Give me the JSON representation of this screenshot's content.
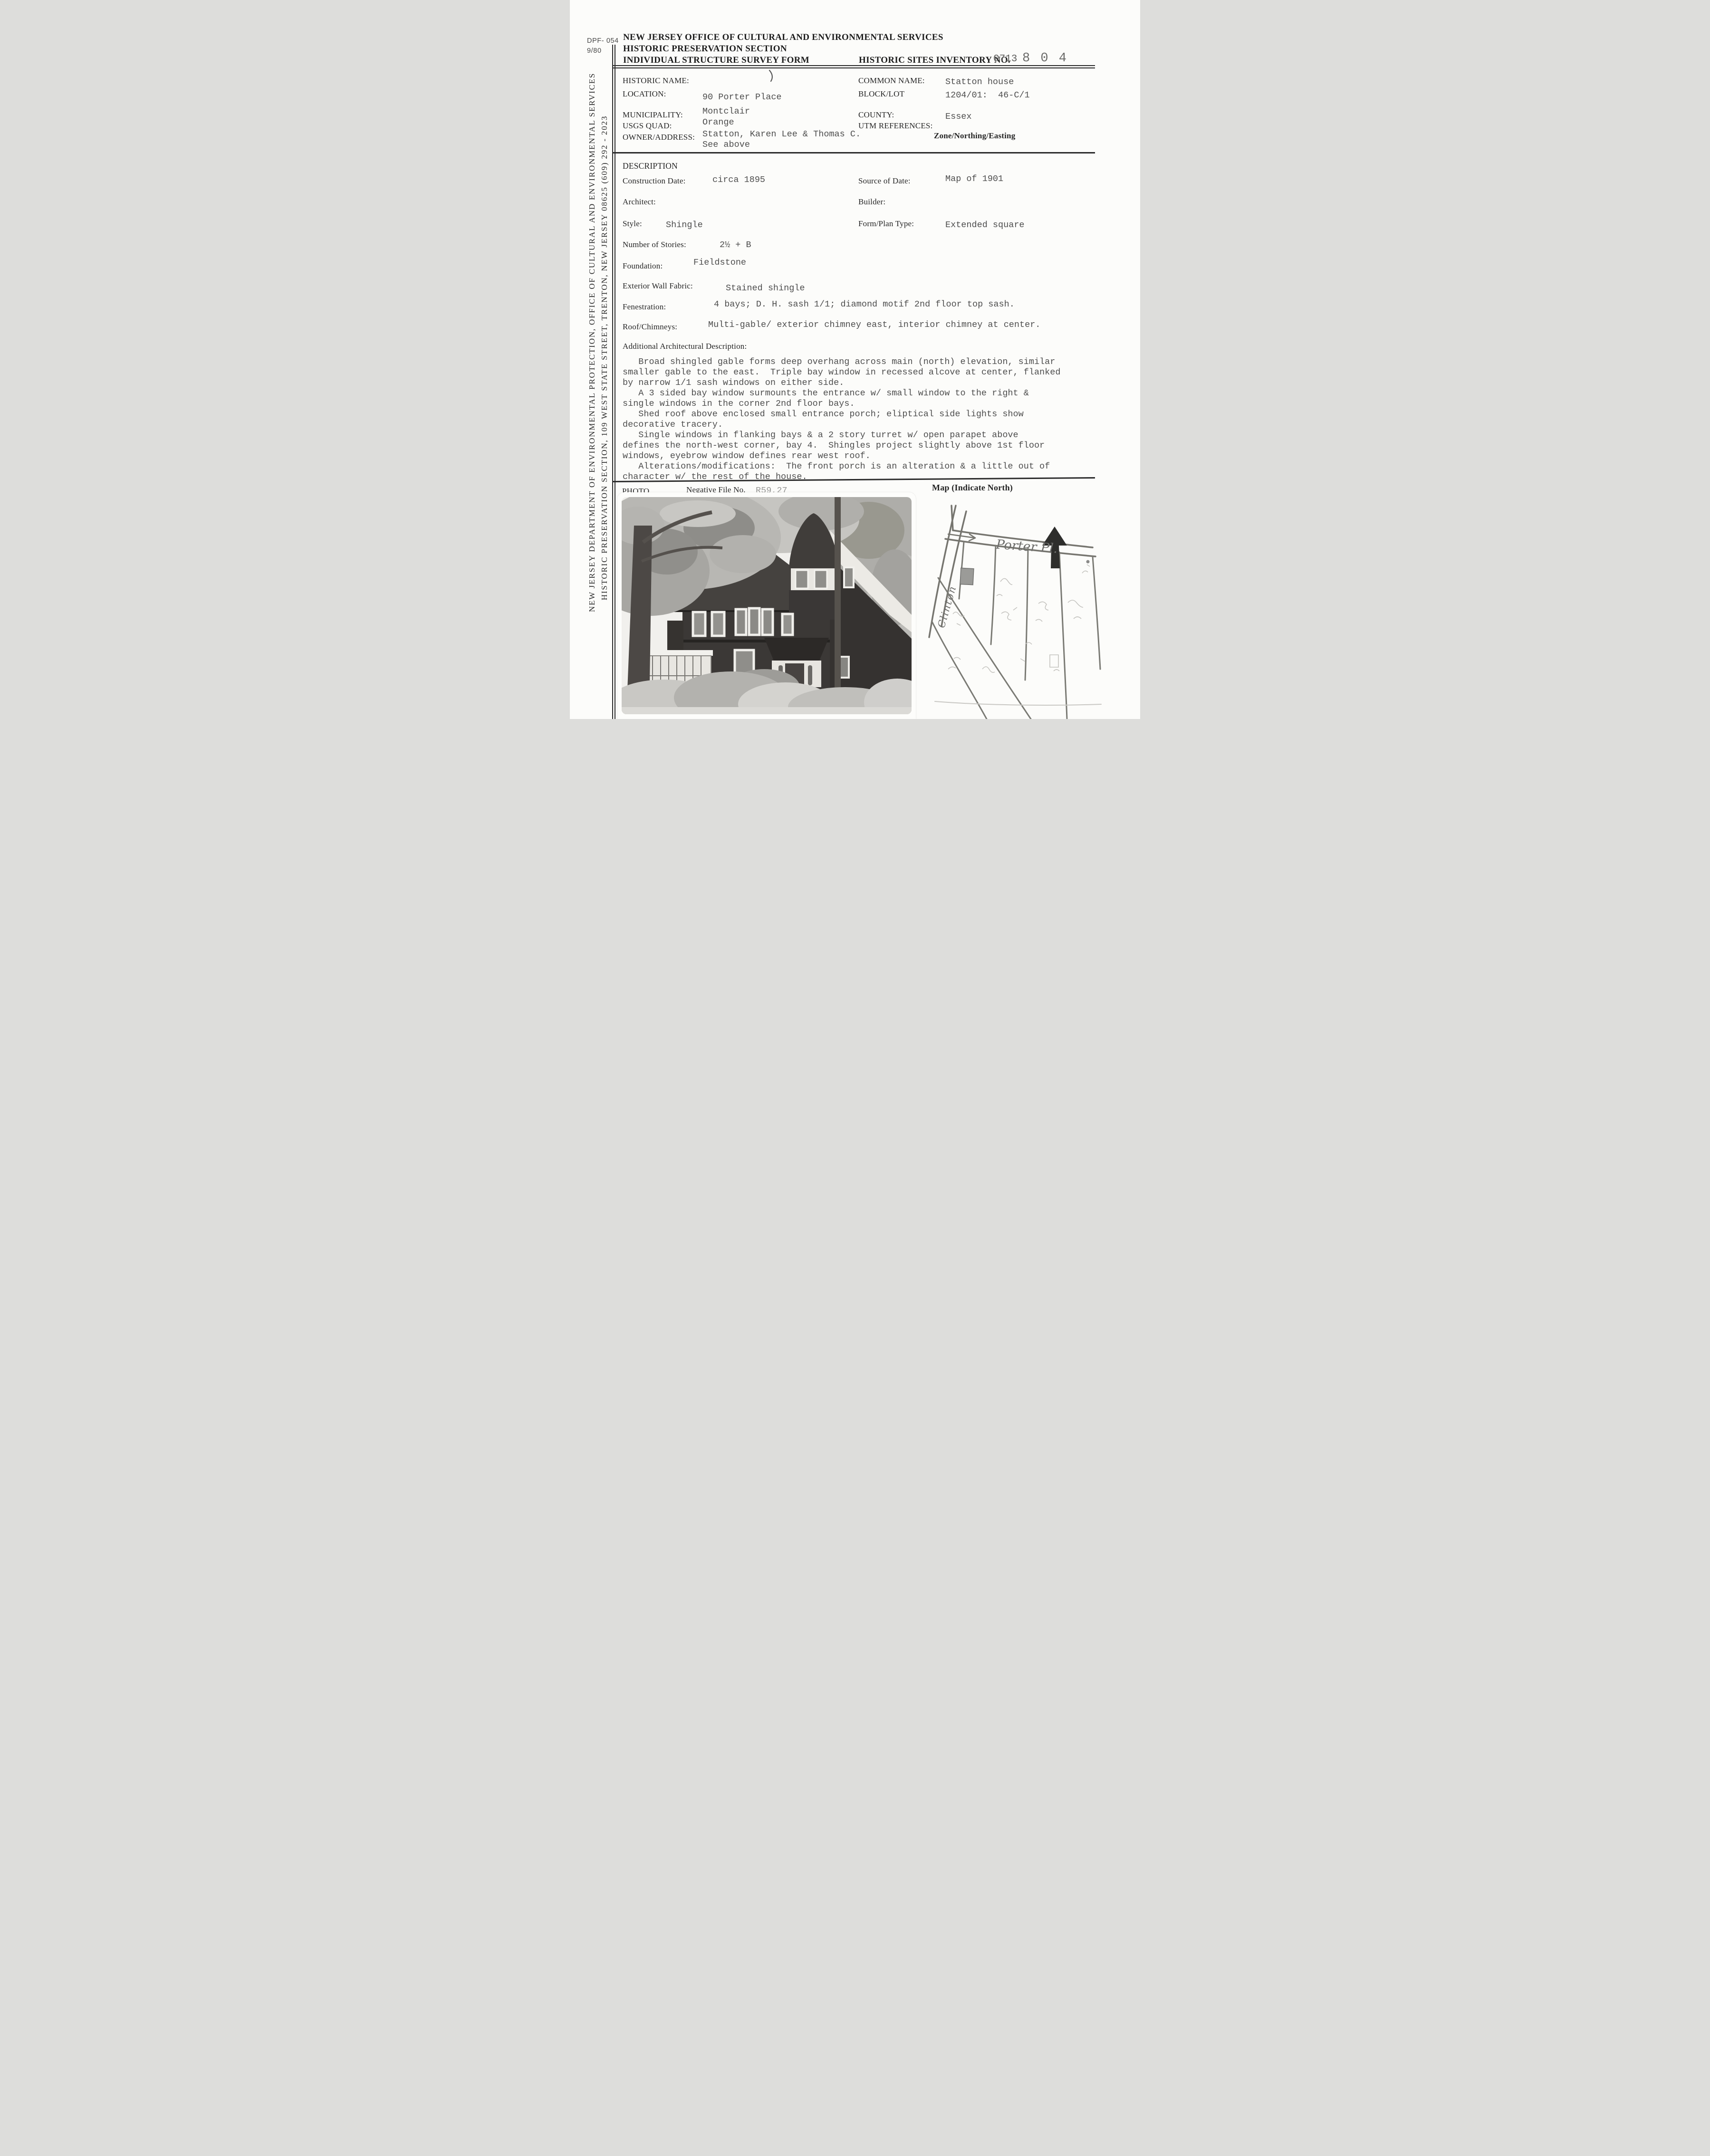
{
  "form_meta": {
    "number": "DPF- 054",
    "revision": "9/80"
  },
  "sidebar": {
    "line_outer": "NEW JERSEY DEPARTMENT OF ENVIRONMENTAL PROTECTION, OFFICE OF CULTURAL AND ENVIRONMENTAL SERVICES",
    "line_inner": "HISTORIC PRESERVATION SECTION, 109 WEST STATE STREET, TRENTON, NEW JERSEY 08625   (609) 292 - 2023"
  },
  "header": {
    "line1": "NEW JERSEY OFFICE OF CULTURAL AND ENVIRONMENTAL SERVICES",
    "line2": "HISTORIC PRESERVATION SECTION",
    "line3": "INDIVIDUAL STRUCTURE SURVEY FORM",
    "inventory_label": "HISTORIC SITES INVENTORY NO.",
    "inventory_typed": "0713",
    "inventory_written": "8 0 4"
  },
  "identity": {
    "historic_name_label": "HISTORIC NAME:",
    "location_label": "LOCATION:",
    "location_value": "90 Porter Place",
    "municipality_label": "MUNICIPALITY:",
    "municipality_value": "Montclair",
    "usgs_label": "USGS QUAD:",
    "usgs_value": "Orange",
    "owner_label": "OWNER/ADDRESS:",
    "owner_value": "Statton, Karen Lee & Thomas C.",
    "owner_value2": "See above",
    "common_name_label": "COMMON NAME:",
    "common_name_value": "Statton house",
    "block_lot_label": "BLOCK/LOT",
    "block_lot_value": "1204/01:  46-C/1",
    "county_label": "COUNTY:",
    "county_value": "Essex",
    "utm_label": "UTM REFERENCES:",
    "utm_sub_label": "Zone/Northing/Easting"
  },
  "description": {
    "section_title": "DESCRIPTION",
    "construction_date_label": "Construction Date:",
    "construction_date_value": "circa 1895",
    "source_label": "Source of Date:",
    "source_value": "Map of 1901",
    "architect_label": "Architect:",
    "builder_label": "Builder:",
    "style_label": "Style:",
    "style_value": "Shingle",
    "form_plan_label": "Form/Plan Type:",
    "form_plan_value": "Extended square",
    "stories_label": "Number of Stories:",
    "stories_value": "2½ + B",
    "foundation_label": "Foundation:",
    "foundation_value": "Fieldstone",
    "wall_label": "Exterior Wall Fabric:",
    "wall_value": "Stained shingle",
    "fenestration_label": "Fenestration:",
    "fenestration_value": "4 bays; D. H. sash 1/1; diamond motif 2nd floor top sash.",
    "roof_label": "Roof/Chimneys:",
    "roof_value": "Multi-gable/ exterior chimney east, interior chimney at center.",
    "additional_label": "Additional Architectural Description:",
    "para_lines": [
      "   Broad shingled gable forms deep overhang across main (north) elevation, similar",
      "smaller gable to the east.  Triple bay window in recessed alcove at center, flanked",
      "by narrow 1/1 sash windows on either side.",
      "   A 3 sided bay window surmounts the entrance w/ small window to the right &",
      "single windows in the corner 2nd floor bays.",
      "   Shed roof above enclosed small entrance porch; eliptical side lights show",
      "decorative tracery.",
      "   Single windows in flanking bays & a 2 story turret w/ open parapet above",
      "defines the north-west corner, bay 4.  Shingles project slightly above 1st floor",
      "windows, eyebrow window defines rear west roof.",
      "   Alterations/modifications:  The front porch is an alteration & a little out of",
      "character w/ the rest of the house."
    ]
  },
  "footer": {
    "photo_label": "PHOTO",
    "negative_label": "Negative File No.",
    "negative_value": "R59,27",
    "map_label": "Map  (Indicate North)"
  },
  "map": {
    "street_porter": "Porter Pl.",
    "street_clinton": "Clinton"
  }
}
